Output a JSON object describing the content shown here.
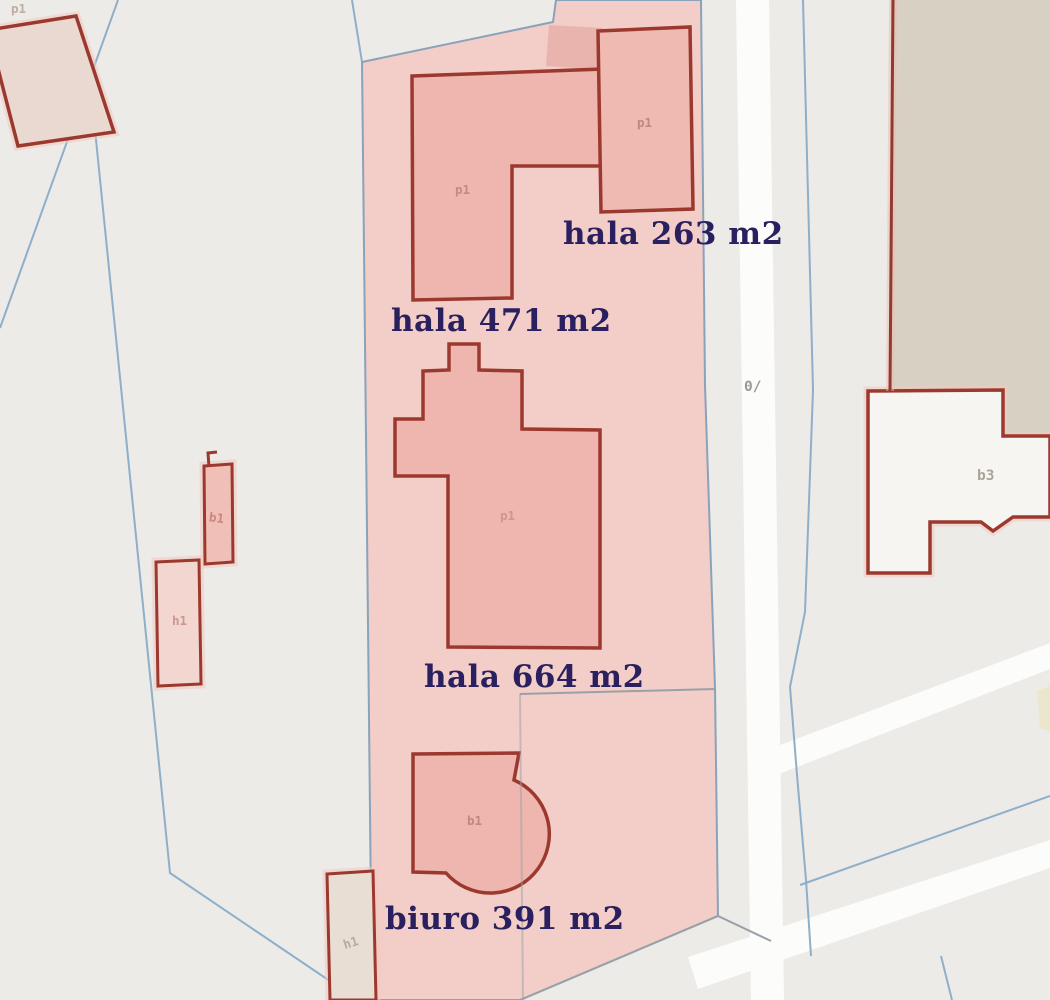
{
  "map": {
    "labels": {
      "hala263": "hala 263 m2",
      "hala471": "hala 471 m2",
      "hala664": "hala 664 m2",
      "biuro391": "biuro 391 m2"
    },
    "codes": {
      "p1": "p1",
      "b1": "b1",
      "h1": "h1",
      "b3": "b3",
      "road_marker": "0/"
    },
    "colors": {
      "background": "#ecebe8",
      "highlight_parcel_fill": "#f3cbc6",
      "building_fill": "#eeb6ae",
      "building_outline": "#9c392f",
      "pale_building_fill": "#ead9d0",
      "beige_area_fill": "#d9d0c4",
      "road_fill": "#fcfcfa",
      "parcel_line_blue": "#8fafc9",
      "parcel_line_gray": "#99a1a8",
      "label_navy": "#2a1f5f"
    }
  }
}
